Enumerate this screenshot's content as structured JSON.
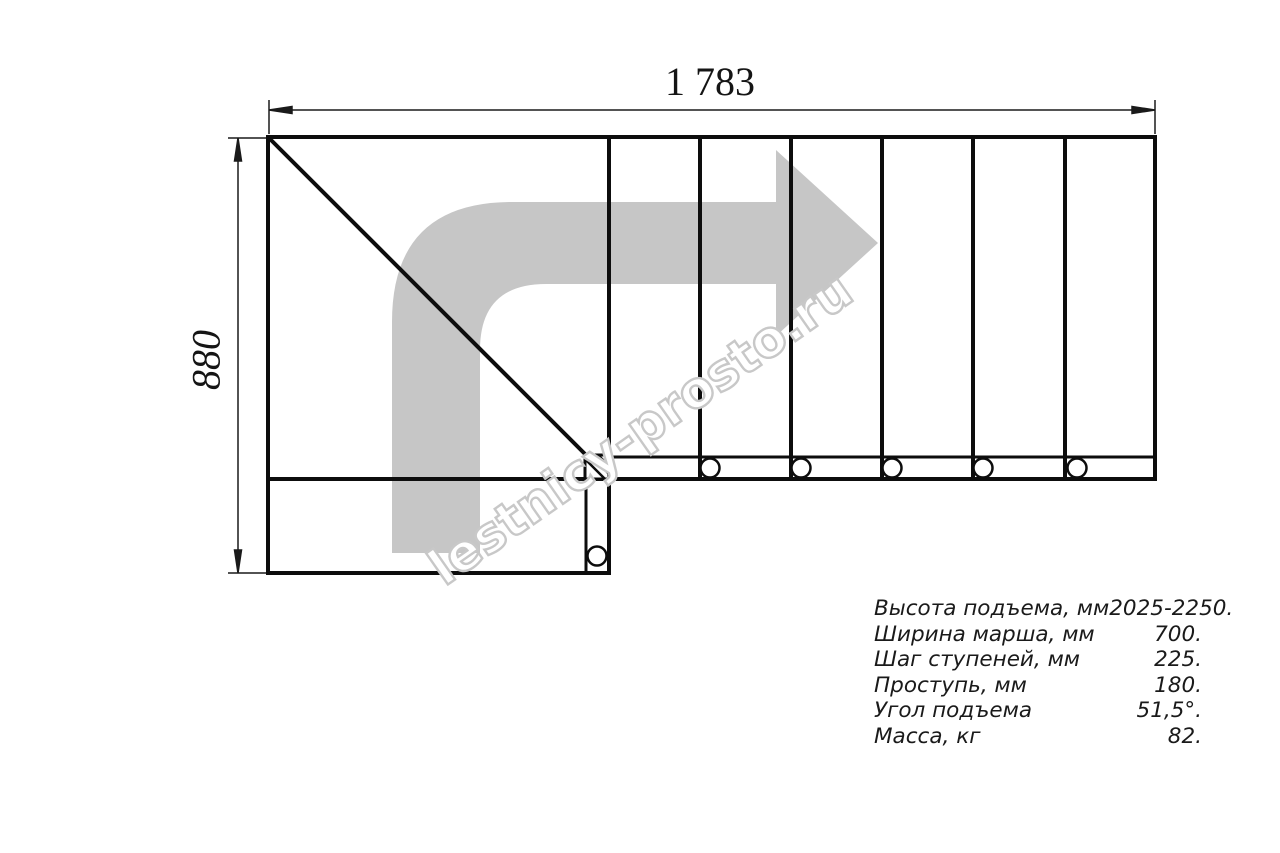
{
  "watermark": {
    "text": "lestnicy-prosto.ru"
  },
  "dimensions": {
    "width_label": "1 783",
    "height_label": "880"
  },
  "specs": {
    "rows": [
      {
        "label": "Высота подъема, мм",
        "value": "2025-2250."
      },
      {
        "label": "Ширина марша, мм",
        "value": "700."
      },
      {
        "label": "Шаг ступеней, мм",
        "value": "225."
      },
      {
        "label": "Проступь, мм",
        "value": "180."
      },
      {
        "label": "Угол подъема",
        "value": "51,5°."
      },
      {
        "label": "Масса, кг",
        "value": "82."
      }
    ]
  },
  "colors": {
    "line": "#0d0d0d",
    "thin_line": "#1a1a1a",
    "arrow_gray": "#c6c6c6",
    "watermark_gray": "#c8c8c8"
  }
}
